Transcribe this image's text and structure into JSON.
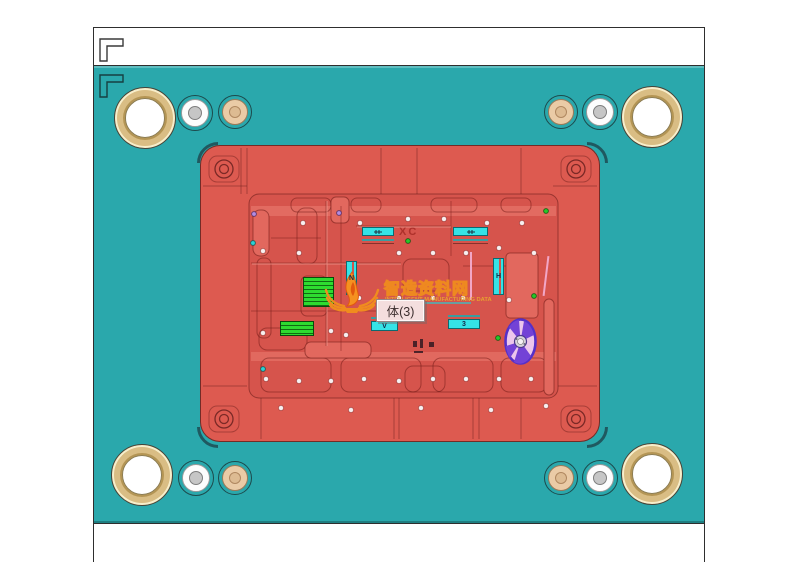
{
  "scene": {
    "description": "3D CAD view of an injection mold plate assembly",
    "tooltip": {
      "label": "体(3)"
    },
    "watermark": {
      "title": "智造资料网",
      "subtitle": "INTELLIGENT MANUFACTURING DATA"
    },
    "markers": {
      "xc": "XC",
      "n": "N",
      "h": "H",
      "v": "V",
      "three": "3"
    },
    "colors": {
      "plate_teal": "#2AA8AC",
      "cavity_red": "#DD5A50",
      "pocket_red": "#D6544C",
      "insert_cyan": "#35E3E6",
      "insert_green": "#2EDB30",
      "impeller_purple": "#6B3AD2",
      "bushing_gold": "#EBD7A0",
      "watermark_orange": "#EE8A1E"
    }
  }
}
